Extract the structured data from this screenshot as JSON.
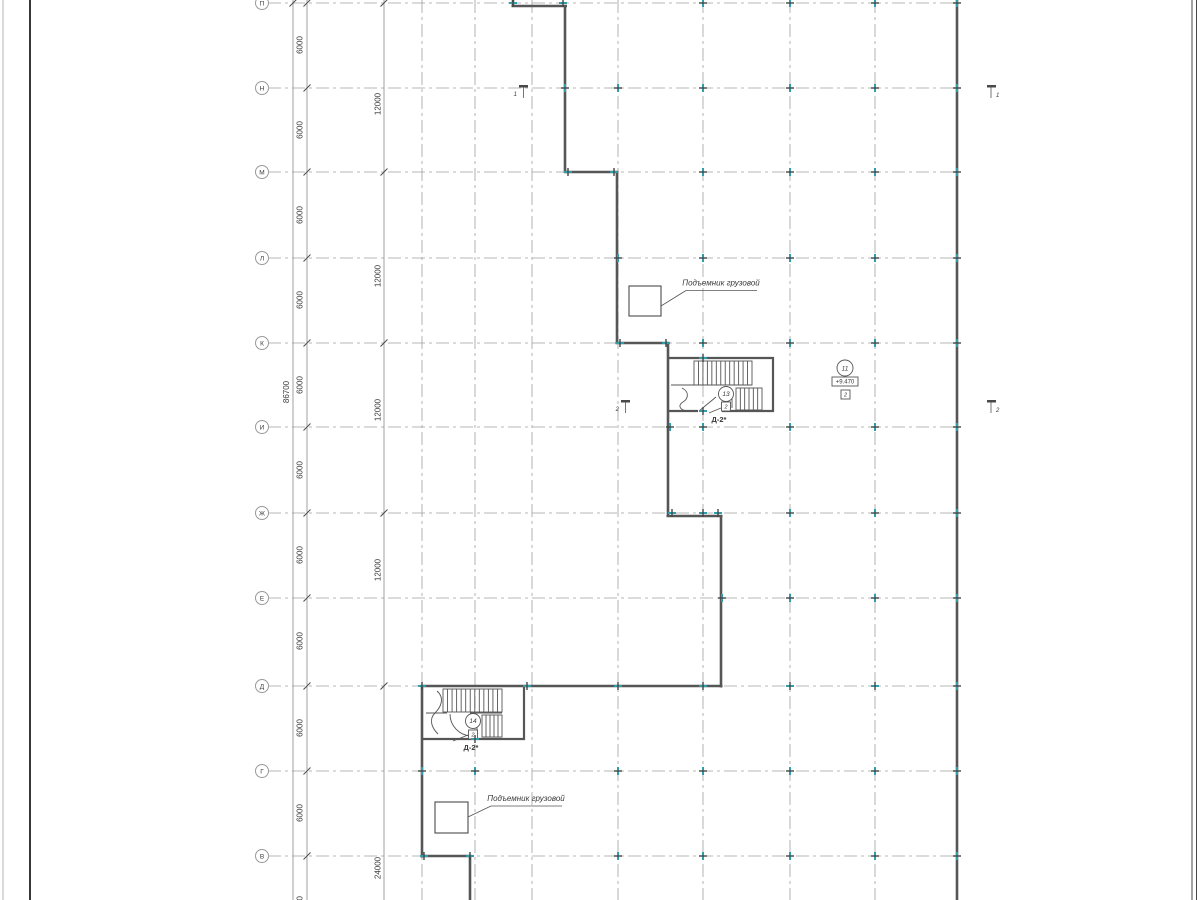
{
  "drawing": {
    "colors": {
      "wall": "#565656",
      "grid": "#a0a0a0",
      "dim": "#8a8a8a",
      "slash": "#4a4a4a",
      "tick_teal": "#2f9ea8",
      "tick_dark": "#444444",
      "text": "#3a3a3a",
      "bubble_border": "#9a9a9a",
      "frame_dark": "#383838",
      "frame_light": "#b5b5b5"
    },
    "frame": {
      "left_outer_x": 3,
      "left_inner_x": 30,
      "right_x1": 1192,
      "right_x2": 1196.5
    },
    "rows": [
      {
        "label": "П",
        "y": 3
      },
      {
        "label": "Н",
        "y": 88
      },
      {
        "label": "М",
        "y": 172
      },
      {
        "label": "Л",
        "y": 258
      },
      {
        "label": "К",
        "y": 343
      },
      {
        "label": "И",
        "y": 427
      },
      {
        "label": "Ж",
        "y": 513
      },
      {
        "label": "Е",
        "y": 598
      },
      {
        "label": "Д",
        "y": 686
      },
      {
        "label": "Г",
        "y": 771
      },
      {
        "label": "В",
        "y": 856
      }
    ],
    "row_line": {
      "x1": 268,
      "x2": 957,
      "bubble_x": 262,
      "bubble_r": 6.5
    },
    "cols": [
      422,
      475,
      532,
      618,
      703,
      790,
      875
    ],
    "dim_chains": [
      {
        "x": 293,
        "text_x": 289,
        "ticks": [
          3
        ],
        "labels": [
          {
            "text": "86700",
            "y": 392
          }
        ]
      },
      {
        "x": 307,
        "text_x": 302.5,
        "ticks": [
          3,
          88,
          172,
          258,
          343,
          427,
          513,
          598,
          686,
          771,
          856
        ],
        "labels": [
          {
            "text": "6000",
            "y": 45
          },
          {
            "text": "6000",
            "y": 130
          },
          {
            "text": "6000",
            "y": 215
          },
          {
            "text": "6000",
            "y": 300
          },
          {
            "text": "6000",
            "y": 385
          },
          {
            "text": "6000",
            "y": 470
          },
          {
            "text": "6000",
            "y": 555
          },
          {
            "text": "6000",
            "y": 641
          },
          {
            "text": "6000",
            "y": 728
          },
          {
            "text": "6000",
            "y": 813
          },
          {
            "text": "6000",
            "y": 905
          }
        ]
      },
      {
        "x": 384,
        "text_x": 380.5,
        "ticks": [
          3,
          172,
          343,
          513,
          686
        ],
        "labels": [
          {
            "text": "12000",
            "y": 104
          },
          {
            "text": "12000",
            "y": 276
          },
          {
            "text": "12000",
            "y": 410
          },
          {
            "text": "12000",
            "y": 570
          },
          {
            "text": "24000",
            "y": 868
          }
        ]
      }
    ],
    "walls": [
      [
        513,
        0,
        513,
        7
      ],
      [
        511.5,
        6,
        567,
        6
      ],
      [
        565,
        6,
        565,
        173
      ],
      [
        564,
        172,
        618.5,
        172
      ],
      [
        617,
        172,
        617,
        344
      ],
      [
        615.5,
        343,
        669.5,
        343
      ],
      [
        668,
        343,
        668,
        517
      ],
      [
        666.5,
        516,
        722.5,
        516
      ],
      [
        721,
        516,
        721,
        687.5
      ],
      [
        420.5,
        686,
        722.5,
        686
      ],
      [
        422,
        686,
        422,
        857.5
      ],
      [
        420.5,
        856,
        471.5,
        856
      ],
      [
        470,
        856,
        470,
        900
      ],
      [
        957,
        0,
        957,
        900
      ]
    ],
    "stairs": [
      {
        "name": "Д-2*",
        "label_x": 719,
        "label_y": 422,
        "walls": [
          [
            668,
            358,
            774,
            358
          ],
          [
            773,
            357,
            773,
            412
          ],
          [
            668,
            411,
            698,
            411
          ],
          [
            722,
            411,
            774,
            411
          ]
        ],
        "boxes": [
          {
            "r": [
              694,
              361,
              58,
              24
            ],
            "n": 12
          },
          {
            "r": [
              736,
              388,
              26,
              22
            ],
            "n": 5
          }
        ],
        "lines": [
          [
            671,
            385,
            752,
            385
          ],
          [
            732,
            389,
            732,
            408
          ]
        ],
        "door": [
          699,
          411,
          716,
          397
        ],
        "scurve": "M682,388 C690,392 688,399 683,402 C678,405 679,409 686,411",
        "circle": {
          "cx": 726,
          "cy": 394,
          "r": 7.5,
          "t": "13"
        },
        "sq": {
          "x": 721.5,
          "y": 402,
          "s": 9,
          "t": "2"
        },
        "leader": [
          721,
          408,
          709,
          413
        ]
      },
      {
        "name": "Д-2*",
        "label_x": 471,
        "label_y": 750,
        "walls": [
          [
            524,
            686,
            524,
            740
          ],
          [
            422,
            739,
            525,
            739
          ]
        ],
        "boxes": [
          {
            "r": [
              443,
              689,
              59,
              23
            ],
            "n": 12
          },
          {
            "r": [
              482,
              715,
              20,
              22
            ],
            "n": 4
          }
        ],
        "lines": [
          [
            426,
            713,
            447,
            713
          ],
          [
            470,
            713,
            502,
            713
          ],
          [
            477,
            714,
            477,
            735
          ]
        ],
        "door_arc": "M450,714 A22,22 0 0 0 471,736",
        "scurve": "M437,691 C445,698 441,707 435,713 C429,719 431,727 438,734",
        "circle": {
          "cx": 473,
          "cy": 721,
          "r": 7.5,
          "t": "14"
        },
        "sq": {
          "x": 468.5,
          "y": 730,
          "s": 9,
          "t": "2"
        },
        "leader": [
          468,
          735,
          453,
          741
        ]
      }
    ],
    "lifts": [
      {
        "rect": [
          629,
          286,
          32,
          30
        ],
        "label": "Подъемник грузовой",
        "label_x": 721,
        "label_y": 288,
        "underline": [
          686,
          290.5,
          757,
          290.5
        ],
        "leader": [
          661,
          306,
          686,
          290.5
        ]
      },
      {
        "rect": [
          435,
          802,
          33,
          31
        ],
        "label": "Подъемник грузовой",
        "label_x": 526,
        "label_y": 803.5,
        "underline": [
          491,
          806,
          562,
          806
        ],
        "leader": [
          468,
          817,
          491,
          806
        ]
      }
    ],
    "section_markers": [
      {
        "bar": [
          519,
          85,
          9,
          2.5
        ],
        "line": [
          523.5,
          87.5,
          523.5,
          98
        ],
        "num": "1",
        "nx": 517,
        "ny": 96,
        "anchor": "end"
      },
      {
        "bar": [
          987,
          85,
          9,
          2.5
        ],
        "line": [
          991,
          87.5,
          991,
          98
        ],
        "num": "1",
        "nx": 996,
        "ny": 97,
        "anchor": "start"
      },
      {
        "bar": [
          621,
          400,
          9,
          2.5
        ],
        "line": [
          625.5,
          402.5,
          625.5,
          413
        ],
        "num": "2",
        "nx": 619,
        "ny": 411,
        "anchor": "end"
      },
      {
        "bar": [
          987,
          400,
          9,
          2.5
        ],
        "line": [
          991,
          402.5,
          991,
          413
        ],
        "num": "2",
        "nx": 996,
        "ny": 412,
        "anchor": "start"
      }
    ],
    "elevation": {
      "circle": {
        "cx": 845,
        "cy": 368,
        "r": 8
      },
      "circle_text": "11",
      "box": {
        "x": 832,
        "y": 377,
        "w": 26,
        "h": 9
      },
      "box_text": "+9.470",
      "square": {
        "x": 841,
        "y": 390,
        "s": 9
      },
      "square_text": "2"
    },
    "ticks": [
      [
        513,
        3,
        "h"
      ],
      [
        563,
        3,
        "h"
      ],
      [
        703,
        3,
        "v"
      ],
      [
        790,
        3,
        "v"
      ],
      [
        875,
        3,
        "v"
      ],
      [
        957,
        3,
        "v"
      ],
      [
        565,
        88,
        "v"
      ],
      [
        618,
        88,
        "v"
      ],
      [
        703,
        88,
        "v"
      ],
      [
        790,
        88,
        "v"
      ],
      [
        875,
        88,
        "v"
      ],
      [
        957,
        88,
        "v"
      ],
      [
        568,
        172,
        "h"
      ],
      [
        614,
        172,
        "h"
      ],
      [
        703,
        172,
        "v"
      ],
      [
        790,
        172,
        "v"
      ],
      [
        875,
        172,
        "v"
      ],
      [
        957,
        172,
        "v"
      ],
      [
        618,
        258,
        "v"
      ],
      [
        703,
        258,
        "v"
      ],
      [
        790,
        258,
        "v"
      ],
      [
        875,
        258,
        "v"
      ],
      [
        957,
        258,
        "v"
      ],
      [
        620,
        343,
        "h"
      ],
      [
        666,
        343,
        "h"
      ],
      [
        703,
        343,
        "v"
      ],
      [
        790,
        343,
        "v"
      ],
      [
        875,
        343,
        "v"
      ],
      [
        957,
        343,
        "v"
      ],
      [
        670,
        427,
        "v"
      ],
      [
        703,
        427,
        "v"
      ],
      [
        790,
        427,
        "v"
      ],
      [
        875,
        427,
        "v"
      ],
      [
        957,
        427,
        "v"
      ],
      [
        672,
        513,
        "h"
      ],
      [
        703,
        513,
        "h"
      ],
      [
        718,
        513,
        "h"
      ],
      [
        790,
        513,
        "v"
      ],
      [
        875,
        513,
        "v"
      ],
      [
        957,
        513,
        "v"
      ],
      [
        722,
        598,
        "v"
      ],
      [
        790,
        598,
        "v"
      ],
      [
        875,
        598,
        "v"
      ],
      [
        957,
        598,
        "v"
      ],
      [
        422,
        686,
        "h"
      ],
      [
        527,
        686,
        "h"
      ],
      [
        618,
        686,
        "h"
      ],
      [
        703,
        686,
        "h"
      ],
      [
        790,
        686,
        "h"
      ],
      [
        875,
        686,
        "h"
      ],
      [
        957,
        686,
        "v"
      ],
      [
        422,
        771,
        "v"
      ],
      [
        475,
        771,
        "v"
      ],
      [
        618,
        771,
        "v"
      ],
      [
        703,
        771,
        "v"
      ],
      [
        790,
        771,
        "v"
      ],
      [
        875,
        771,
        "v"
      ],
      [
        957,
        771,
        "v"
      ],
      [
        424,
        856,
        "h"
      ],
      [
        470,
        856,
        "h"
      ],
      [
        618,
        856,
        "v"
      ],
      [
        703,
        856,
        "v"
      ],
      [
        790,
        856,
        "v"
      ],
      [
        875,
        856,
        "v"
      ],
      [
        957,
        856,
        "v"
      ],
      [
        703,
        358,
        "h"
      ],
      [
        703,
        411,
        "h"
      ],
      [
        475,
        739,
        "h"
      ]
    ]
  }
}
